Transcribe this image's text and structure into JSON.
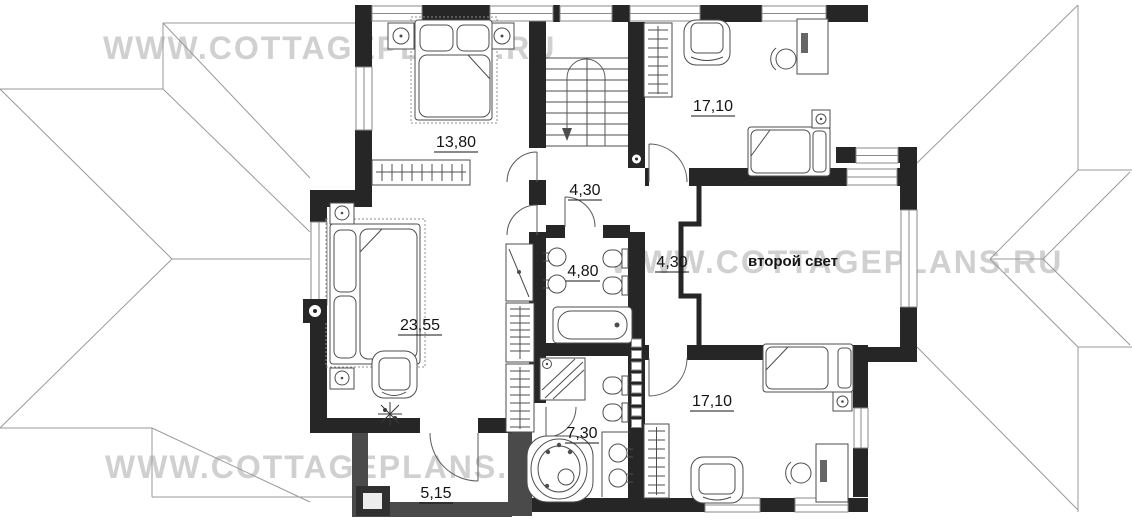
{
  "title": "Cottage second floor plan",
  "watermark": {
    "text": "WWW.COTTAGEPLANS.RU",
    "color": "#c8c8c8"
  },
  "palette": {
    "wall": "#262626",
    "terrace_wall": "#4a4a4a",
    "furniture_line": "#4d4d4d",
    "roof_line": "#9a9a9a",
    "label_color": "#141414"
  },
  "plan": {
    "rooms": [
      {
        "id": "bedroom-top-left",
        "label": "13,80"
      },
      {
        "id": "bedroom-top-right",
        "label": "17,10"
      },
      {
        "id": "hall",
        "label": "4,30"
      },
      {
        "id": "bathroom-top",
        "label": "4,80"
      },
      {
        "id": "corridor",
        "label": "4,30"
      },
      {
        "id": "second-light",
        "label": "второй свет"
      },
      {
        "id": "bedroom-master",
        "label": "23,55"
      },
      {
        "id": "bathroom-bottom",
        "label": "7,30"
      },
      {
        "id": "bedroom-bottom-right",
        "label": "17,10"
      },
      {
        "id": "balcony",
        "label": "5,15"
      }
    ]
  }
}
